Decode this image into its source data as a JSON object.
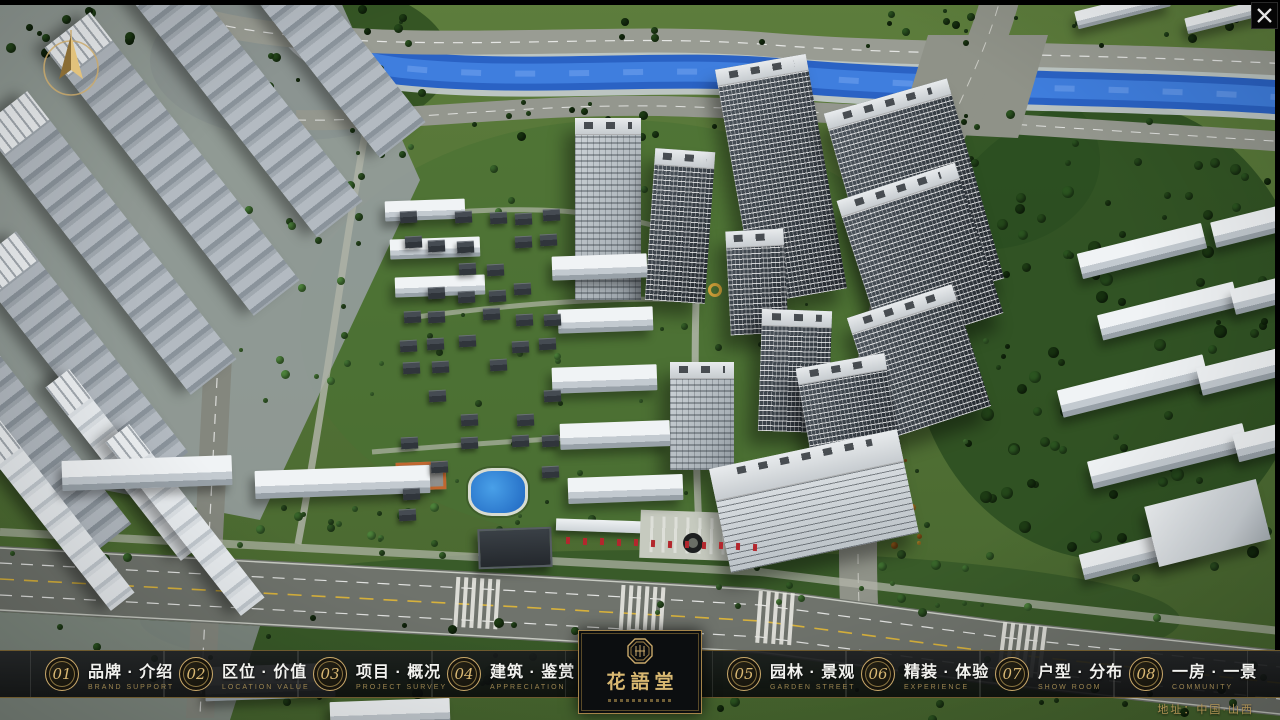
{
  "nav": {
    "items": [
      {
        "num": "01",
        "zh": "品牌 · 介绍",
        "en": "BRAND SUPPORT"
      },
      {
        "num": "02",
        "zh": "区位 · 价值",
        "en": "LOCATION VALUE"
      },
      {
        "num": "03",
        "zh": "项目 · 概况",
        "en": "PROJECT SURVEY"
      },
      {
        "num": "04",
        "zh": "建筑 · 鉴赏",
        "en": "APPRECIATION"
      },
      {
        "num": "05",
        "zh": "园林 · 景观",
        "en": "GARDEN STREET"
      },
      {
        "num": "06",
        "zh": "精装 · 体验",
        "en": "EXPERIENCE"
      },
      {
        "num": "07",
        "zh": "户型 · 分布",
        "en": "SHOW ROOM"
      },
      {
        "num": "08",
        "zh": "一房 · 一景",
        "en": "COMMUNITY"
      }
    ]
  },
  "logo": {
    "title": "花語堂"
  },
  "footer": {
    "address": "地址：中国·山西"
  },
  "icons": {
    "close": "✕",
    "compass": "north-arrow"
  },
  "colors": {
    "gold": "#c9a86a",
    "river_blue": "#2a62c4",
    "navbar_bg": "#0b0d0e"
  }
}
